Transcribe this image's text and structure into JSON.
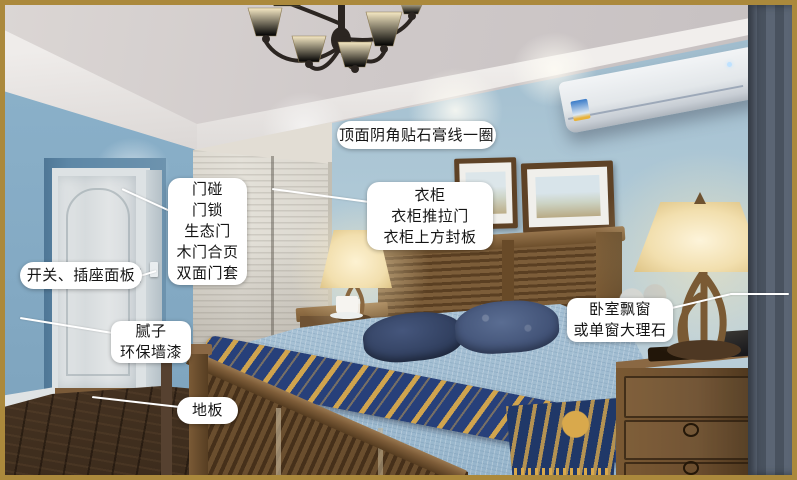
{
  "annotations": {
    "ceiling_label": "顶面阴角贴石膏线一圈",
    "door_lines": [
      "门碰",
      "门锁",
      "生态门",
      "木门合页",
      "双面门套"
    ],
    "switch_label": "开关、插座面板",
    "wall_lines": [
      "腻子",
      "环保墙漆"
    ],
    "floor_label": "地板",
    "wardrobe_lines": [
      "衣柜",
      "衣柜推拉门",
      "衣柜上方封板"
    ],
    "window_lines": [
      "卧室飘窗",
      "或单窗大理石"
    ]
  },
  "palette": {
    "frame_gold": "#ab893c",
    "label_background": "#ffffff",
    "label_text": "#151515",
    "wall_blue": "#8db3cb",
    "back_wall_blue": "#a9c3d3",
    "ceiling_grey": "#cfc9c8",
    "wood_brown": "#6e4f2f",
    "quilt_blue": "#b5cbdc",
    "throw_navy": "#27407a",
    "throw_gold": "#d9a94c",
    "curtain_grey": "#566070",
    "lamp_cream": "#f2dfae"
  }
}
